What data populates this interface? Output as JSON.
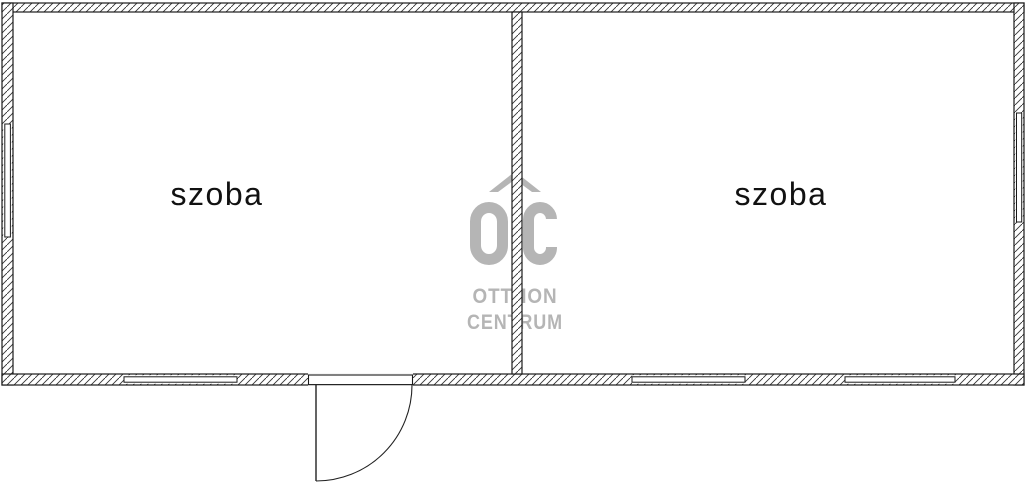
{
  "rooms": [
    {
      "label": "szoba"
    },
    {
      "label": "szoba"
    }
  ],
  "watermark": {
    "monogram": "OC",
    "line1": "OTTHON",
    "line2": "CENTRUM",
    "color": "#b5b5b5"
  },
  "plan": {
    "background": "#ffffff",
    "wall_outline": "#1a1a1a",
    "hatch_line": "#333333"
  }
}
